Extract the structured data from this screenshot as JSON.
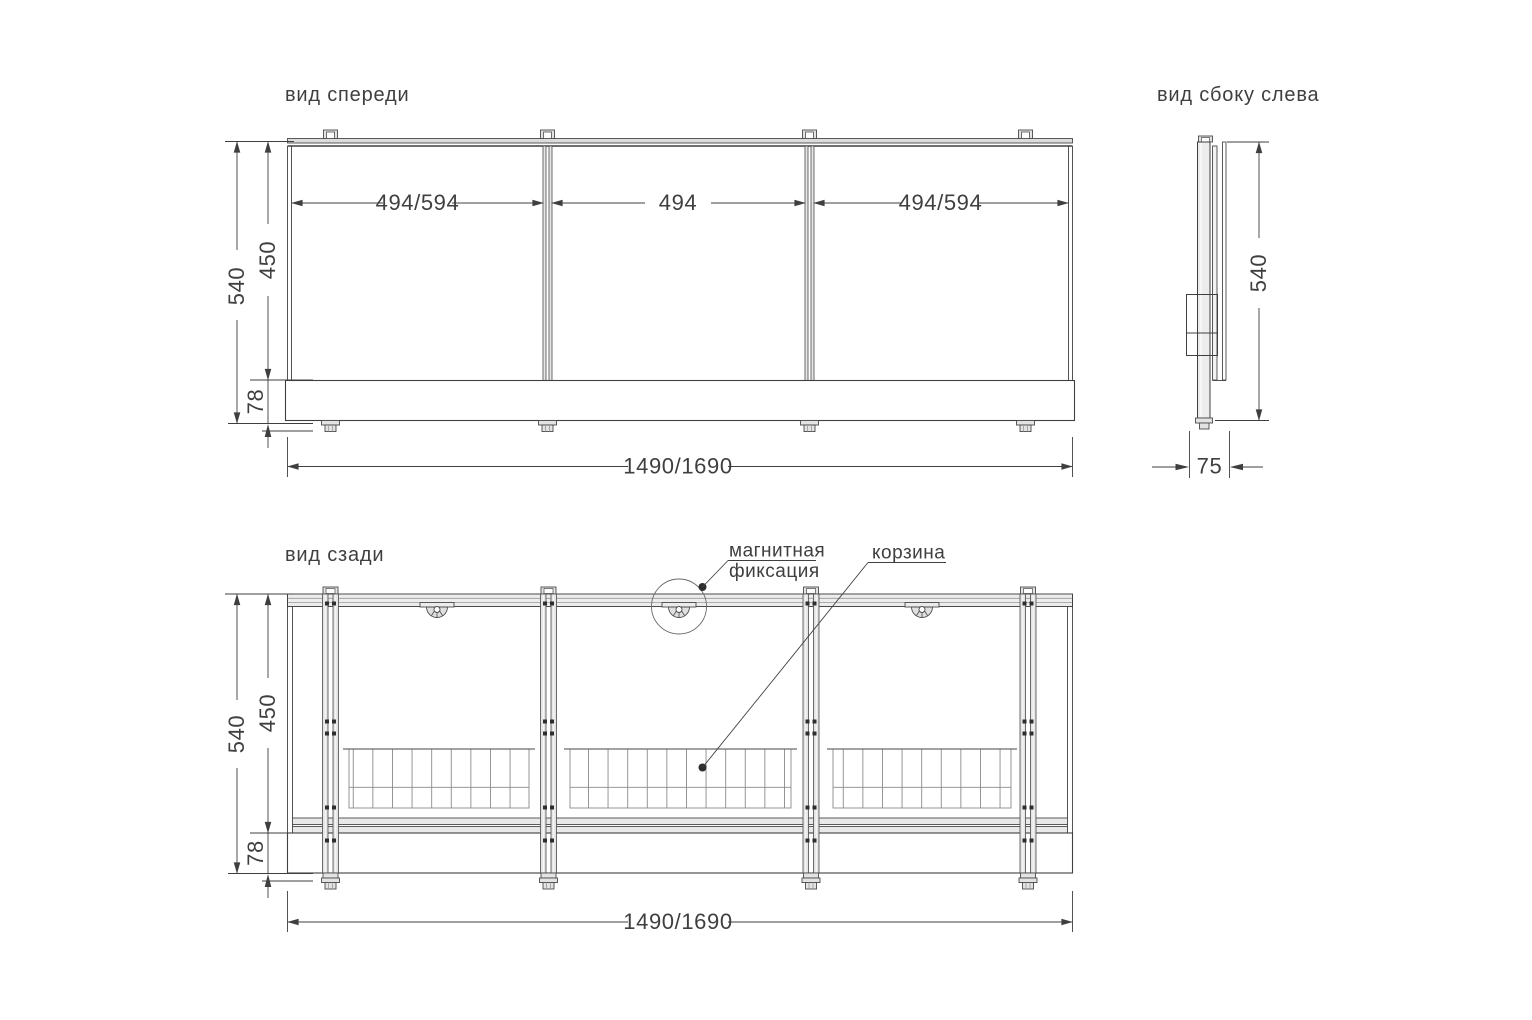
{
  "meta": {
    "background": "#ffffff",
    "line_color": "#3f3f3f",
    "light_fill": "#e8e8e8"
  },
  "views": {
    "front": {
      "title": "вид спереди",
      "dims": {
        "section_left": "494/594",
        "section_middle": "494",
        "section_right": "494/594",
        "height_total": "540",
        "height_glass": "450",
        "height_plinth": "78",
        "width_total": "1490/1690"
      }
    },
    "side": {
      "title": "вид сбоку слева",
      "dims": {
        "height_total": "540",
        "depth": "75"
      }
    },
    "rear": {
      "title": "вид сзади",
      "dims": {
        "height_total": "540",
        "height_glass": "450",
        "height_plinth": "78",
        "width_total": "1490/1690"
      },
      "callouts": {
        "magnet_line1": "магнитная",
        "magnet_line2": "фиксация",
        "basket": "корзина"
      }
    }
  }
}
